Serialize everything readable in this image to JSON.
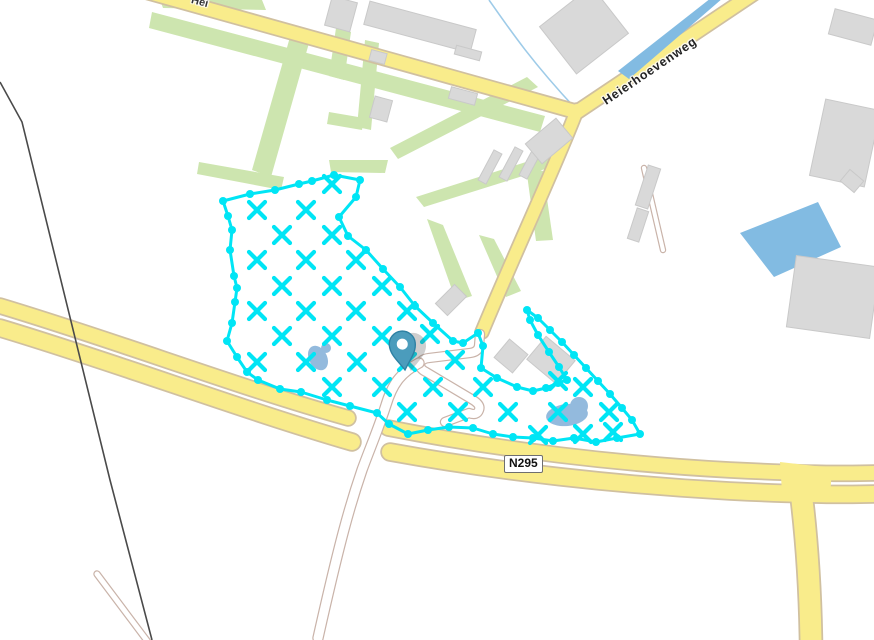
{
  "labels": {
    "top_road_partial": "Hei",
    "diagonal_road": "Heierhoevenweg",
    "route_ref": "N295"
  },
  "colors": {
    "background": "#ffffff",
    "road_fill": "#f9ec8b",
    "road_casing": "#d0c0a0",
    "path_fill": "#ffffff",
    "path_casing": "#c9b3a9",
    "green_area": "#cde5af",
    "building_fill": "#d9d9d9",
    "building_stroke": "#c9c9c9",
    "water_large": "#82bbe2",
    "water_pond": "#93badd",
    "stream": "#9ecbe8",
    "selection_cyan": "#00e5f5",
    "pin_fill": "#4b9cbc",
    "pin_stroke": "#2e81a3",
    "powerline": "#4a4a4a"
  },
  "map": {
    "green": [
      [
        [
          152,
          12
        ],
        [
          545,
          116
        ],
        [
          540,
          132
        ],
        [
          149,
          28
        ]
      ],
      [
        [
          160,
          0
        ],
        [
          262,
          0
        ],
        [
          266,
          10
        ],
        [
          163,
          8
        ]
      ],
      [
        [
          292,
          30
        ],
        [
          311,
          36
        ],
        [
          271,
          177
        ],
        [
          252,
          170
        ]
      ],
      [
        [
          336,
          28
        ],
        [
          351,
          32
        ],
        [
          344,
          80
        ],
        [
          329,
          76
        ]
      ],
      [
        [
          365,
          40
        ],
        [
          379,
          43
        ],
        [
          371,
          130
        ],
        [
          357,
          127
        ]
      ],
      [
        [
          329,
          112
        ],
        [
          364,
          118
        ],
        [
          362,
          130
        ],
        [
          327,
          124
        ]
      ],
      [
        [
          199,
          162
        ],
        [
          284,
          177
        ],
        [
          281,
          190
        ],
        [
          197,
          174
        ]
      ],
      [
        [
          329,
          160
        ],
        [
          388,
          160
        ],
        [
          385,
          173
        ],
        [
          331,
          172
        ]
      ],
      [
        [
          527,
          77
        ],
        [
          538,
          87
        ],
        [
          398,
          159
        ],
        [
          390,
          148
        ]
      ],
      [
        [
          551,
          154
        ],
        [
          561,
          164
        ],
        [
          424,
          207
        ],
        [
          416,
          197
        ]
      ],
      [
        [
          526,
          167
        ],
        [
          543,
          171
        ],
        [
          553,
          240
        ],
        [
          536,
          241
        ]
      ],
      [
        [
          427,
          219
        ],
        [
          443,
          225
        ],
        [
          472,
          296
        ],
        [
          456,
          301
        ]
      ],
      [
        [
          479,
          235
        ],
        [
          494,
          239
        ],
        [
          521,
          291
        ],
        [
          506,
          297
        ]
      ]
    ],
    "roads": [
      {
        "d": "M 140,-10 L 577,112 L 762,-12",
        "w": 13
      },
      {
        "d": "M 577,110 C 556,165 516,250 482,332",
        "w": 12
      },
      {
        "d": "M 0,306 C 120,342 240,388 348,418",
        "w": 14
      },
      {
        "d": "M 388,428 C 500,450 620,464 730,470 C 790,473 840,474 874,473",
        "w": 14
      },
      {
        "d": "M 0,328 C 120,364 242,410 352,442",
        "w": 16
      },
      {
        "d": "M 390,452 C 500,472 620,485 730,491 C 790,494 842,495 874,494",
        "w": 16
      },
      {
        "d": "M 800,484 C 806,530 810,580 811,642",
        "w": 21
      }
    ],
    "junction_patch": "780,462 832,468 830,497 782,492",
    "paths": [
      {
        "d": "M 480,334 L 479,346 Q 478,352 470,353 L 429,358 Q 420,359 420,365 Q 420,369 426,372 L 473,400 Q 481,405 479,410 Q 477,416 469,413 L 445,422",
        "w": 8
      },
      {
        "d": "M 419,363 C 400,373 392,385 386,405 C 378,430 370,448 362,470 C 350,505 340,540 318,638",
        "w": 9
      },
      {
        "d": "M 97,574 L 148,642",
        "w": 5
      },
      {
        "d": "M 644,168 L 663,250",
        "w": 4
      }
    ],
    "powerline": "M 0,82 L 22,122 L 110,480 L 152,640",
    "water": {
      "canal": "618,71 711,-2 723,-2 629,79",
      "basin": "740,233 818,202 841,247 774,277",
      "stream": "M 489,0 C 510,30 532,62 575,108",
      "ponds": [
        {
          "cx": 318,
          "cy": 358,
          "rx": 9,
          "ry": 13,
          "rot": -28,
          "tx": 326,
          "ty": 348,
          "tr": 5
        },
        {
          "cx": 567,
          "cy": 415,
          "rx": 21,
          "ry": 11,
          "rot": -6,
          "tx": 579,
          "ty": 406,
          "tr": 9
        }
      ]
    },
    "buildings": [
      {
        "cx": 341,
        "cy": 14,
        "w": 26,
        "h": 30,
        "rot": 15
      },
      {
        "cx": 420,
        "cy": 27,
        "w": 110,
        "h": 24,
        "rot": 15
      },
      {
        "cx": 378,
        "cy": 57,
        "w": 16,
        "h": 11,
        "rot": 15
      },
      {
        "cx": 468,
        "cy": 53,
        "w": 26,
        "h": 9,
        "rot": 15
      },
      {
        "cx": 381,
        "cy": 109,
        "w": 18,
        "h": 22,
        "rot": 15
      },
      {
        "cx": 463,
        "cy": 96,
        "w": 27,
        "h": 12,
        "rot": 15
      },
      {
        "cx": 584,
        "cy": 30,
        "w": 66,
        "h": 60,
        "rot": -38
      },
      {
        "cx": 853,
        "cy": 27,
        "w": 44,
        "h": 26,
        "rot": 15
      },
      {
        "cx": 845,
        "cy": 143,
        "w": 56,
        "h": 78,
        "rot": 12
      },
      {
        "cx": 852,
        "cy": 181,
        "w": 18,
        "h": 15,
        "rot": 40
      },
      {
        "cx": 833,
        "cy": 297,
        "w": 84,
        "h": 72,
        "rot": 8
      },
      {
        "cx": 490,
        "cy": 167,
        "w": 34,
        "h": 9,
        "rot": -62
      },
      {
        "cx": 511,
        "cy": 164,
        "w": 34,
        "h": 9,
        "rot": -62
      },
      {
        "cx": 531,
        "cy": 162,
        "w": 34,
        "h": 9,
        "rot": -62
      },
      {
        "cx": 549,
        "cy": 141,
        "w": 40,
        "h": 26,
        "rot": -40
      },
      {
        "cx": 451,
        "cy": 300,
        "w": 27,
        "h": 17,
        "rot": -45
      },
      {
        "cx": 511,
        "cy": 356,
        "w": 24,
        "h": 24,
        "rot": 40
      },
      {
        "cx": 551,
        "cy": 360,
        "w": 38,
        "h": 30,
        "rot": 40
      },
      {
        "cx": 648,
        "cy": 187,
        "w": 13,
        "h": 42,
        "rot": 18
      },
      {
        "cx": 638,
        "cy": 225,
        "w": 12,
        "h": 32,
        "rot": 18
      }
    ]
  },
  "selection": {
    "outline": [
      [
        223,
        201
      ],
      [
        250,
        194
      ],
      [
        275,
        190
      ],
      [
        299,
        184
      ],
      [
        312,
        181
      ],
      [
        334,
        175
      ],
      [
        360,
        180
      ],
      [
        356,
        197
      ],
      [
        339,
        217
      ],
      [
        348,
        236
      ],
      [
        366,
        250
      ],
      [
        383,
        269
      ],
      [
        400,
        287
      ],
      [
        415,
        306
      ],
      [
        433,
        323
      ],
      [
        453,
        341
      ],
      [
        463,
        343
      ],
      [
        478,
        333
      ],
      [
        483,
        346
      ],
      [
        481,
        368
      ],
      [
        497,
        378
      ],
      [
        517,
        387
      ],
      [
        533,
        391
      ],
      [
        546,
        388
      ],
      [
        558,
        383
      ],
      [
        567,
        380
      ],
      [
        559,
        367
      ],
      [
        549,
        352
      ],
      [
        538,
        335
      ],
      [
        530,
        320
      ],
      [
        527,
        310
      ],
      [
        538,
        318
      ],
      [
        550,
        330
      ],
      [
        562,
        342
      ],
      [
        574,
        355
      ],
      [
        586,
        368
      ],
      [
        598,
        381
      ],
      [
        610,
        394
      ],
      [
        622,
        408
      ],
      [
        632,
        420
      ],
      [
        640,
        434
      ],
      [
        617,
        438
      ],
      [
        596,
        442
      ],
      [
        574,
        438
      ],
      [
        553,
        441
      ],
      [
        533,
        438
      ],
      [
        513,
        437
      ],
      [
        493,
        434
      ],
      [
        473,
        428
      ],
      [
        449,
        427
      ],
      [
        428,
        430
      ],
      [
        408,
        434
      ],
      [
        389,
        424
      ],
      [
        377,
        413
      ],
      [
        350,
        406
      ],
      [
        327,
        400
      ],
      [
        301,
        392
      ],
      [
        280,
        389
      ],
      [
        258,
        380
      ],
      [
        247,
        372
      ],
      [
        237,
        357
      ],
      [
        227,
        341
      ],
      [
        232,
        323
      ],
      [
        235,
        302
      ],
      [
        237,
        288
      ],
      [
        234,
        276
      ],
      [
        230,
        250
      ],
      [
        232,
        230
      ],
      [
        228,
        216
      ]
    ],
    "xmarks": [
      [
        332,
        184
      ],
      [
        257,
        210
      ],
      [
        306,
        210
      ],
      [
        282,
        235
      ],
      [
        332,
        235
      ],
      [
        257,
        260
      ],
      [
        306,
        260
      ],
      [
        356,
        260
      ],
      [
        282,
        286
      ],
      [
        332,
        286
      ],
      [
        382,
        286
      ],
      [
        257,
        311
      ],
      [
        306,
        311
      ],
      [
        356,
        311
      ],
      [
        407,
        311
      ],
      [
        282,
        336
      ],
      [
        332,
        336
      ],
      [
        382,
        336
      ],
      [
        430,
        334
      ],
      [
        257,
        362
      ],
      [
        306,
        362
      ],
      [
        357,
        362
      ],
      [
        407,
        362
      ],
      [
        455,
        360
      ],
      [
        332,
        387
      ],
      [
        382,
        387
      ],
      [
        433,
        387
      ],
      [
        483,
        387
      ],
      [
        558,
        381
      ],
      [
        583,
        387
      ],
      [
        407,
        412
      ],
      [
        458,
        412
      ],
      [
        508,
        412
      ],
      [
        558,
        412
      ],
      [
        609,
        412
      ],
      [
        538,
        435
      ],
      [
        583,
        434
      ],
      [
        613,
        432
      ]
    ],
    "stroke_width": 3,
    "dot_radius": 4,
    "x_size": 8,
    "x_stroke": 4.2
  },
  "marker": {
    "x": 405,
    "y": 370,
    "rot": -6
  }
}
